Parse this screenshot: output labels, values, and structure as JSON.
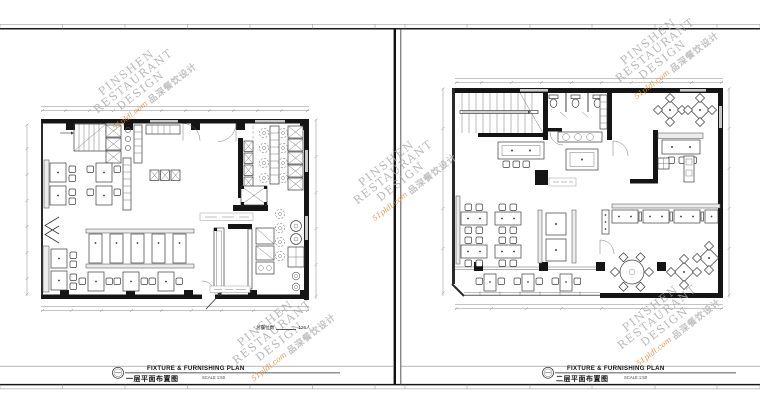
{
  "sheets": [
    {
      "name": "first-floor",
      "title_en": "FIXTURE & FURNISHING PLAN",
      "title_cn": "一层平面布置图",
      "scale_label": "SCALE 1:50"
    },
    {
      "name": "second-floor",
      "title_en": "FIXTURE & FURNISHING PLAN",
      "title_cn": "二层平面布置图",
      "scale_label": "SCALE 1:50"
    }
  ],
  "annotations": {
    "seat_count_label": "总餐位数",
    "seat_count_value": "126人"
  },
  "watermark": {
    "line1": "PINSHEN",
    "line2": "RESTAURANT",
    "line3": "DESIGN",
    "domain": "51pldl.com",
    "brand_cn": "品深餐饮设计"
  },
  "colors": {
    "paper": "#ffffff",
    "wall": "#151515",
    "furniture_line": "#3c3c3c",
    "dimension_line": "#8a8a8a",
    "window_fill": "#c6c6c6",
    "watermark_gray": "#a8a8a8",
    "watermark_orange": "#e0862c"
  }
}
